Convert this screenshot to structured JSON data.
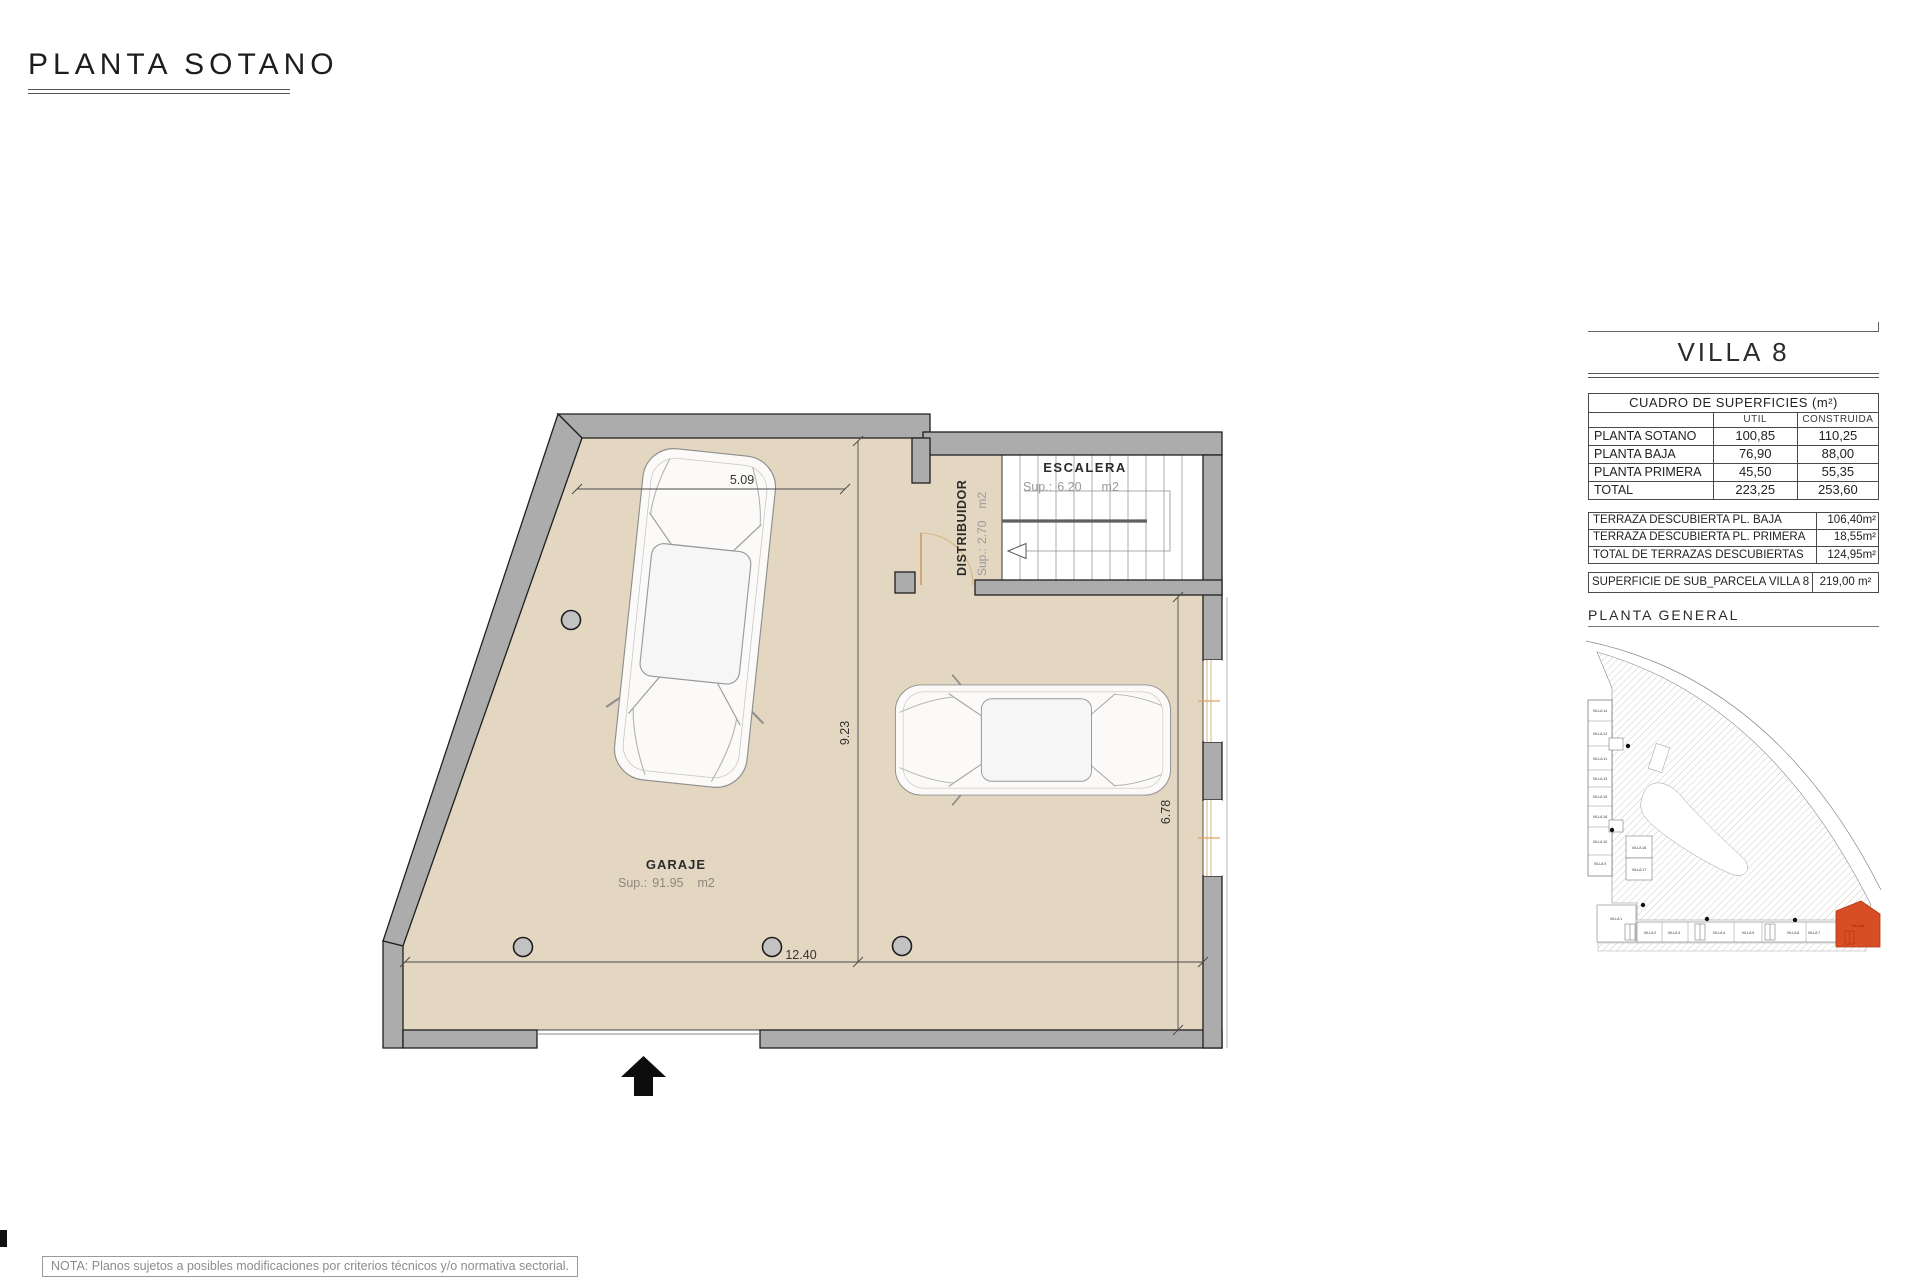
{
  "page": {
    "title": "PLANTA SOTANO",
    "note": "NOTA: Planos sujetos a posibles modificaciones por criterios técnicos y/o normativa sectorial."
  },
  "plan": {
    "rooms": {
      "garaje": {
        "name": "GARAJE",
        "sup_label": "Sup.:",
        "area": "91.95",
        "unit": "m2"
      },
      "escalera": {
        "name": "ESCALERA",
        "sup_label": "Sup.:",
        "area": "6.20",
        "unit": "m2"
      },
      "distribuidor": {
        "name": "DISTRIBUIDOR",
        "sup_label": "Sup.:",
        "area": "2.70",
        "unit": "m2"
      }
    },
    "dimensions": {
      "top": "5.09",
      "middle_vertical": "9.23",
      "right_vertical": "6.78",
      "bottom": "12.40"
    }
  },
  "panel": {
    "villa_title": "VILLA 8",
    "surfaces": {
      "title": "CUADRO DE SUPERFICIES (m²)",
      "col_util": "UTIL",
      "col_construida": "CONSTRUIDA",
      "rows": [
        {
          "label": "PLANTA SOTANO",
          "util": "100,85",
          "construida": "110,25"
        },
        {
          "label": "PLANTA BAJA",
          "util": "76,90",
          "construida": "88,00"
        },
        {
          "label": "PLANTA PRIMERA",
          "util": "45,50",
          "construida": "55,35"
        },
        {
          "label": "TOTAL",
          "util": "223,25",
          "construida": "253,60"
        }
      ]
    },
    "terraces": {
      "rows": [
        {
          "label": "TERRAZA DESCUBIERTA PL. BAJA",
          "value": "106,40m²"
        },
        {
          "label": "TERRAZA DESCUBIERTA PL. PRIMERA",
          "value": "18,55m²"
        },
        {
          "label": "TOTAL DE TERRAZAS DESCUBIERTAS",
          "value": "124,95m²"
        }
      ]
    },
    "subparcel": {
      "label": "SUPERFICIE DE SUB_PARCELA VILLA 8",
      "value": "219,00 m²"
    },
    "site_plan": {
      "title": "PLANTA GENERAL",
      "left_villas": [
        "VILLA 14",
        "VILLA 12",
        "VILLA 11",
        "VILLA 13",
        "VILLA 15",
        "VILLA 16",
        "VILLA 10",
        "VILLA 9"
      ],
      "inner_villas": [
        "VILLA 18",
        "VILLA 17"
      ],
      "bottom_villas": [
        "VILLA 1",
        "VILLA 2",
        "VILLA 3",
        "VILLA 4",
        "VILLA 5",
        "VILLA 6",
        "VILLA 7"
      ],
      "highlight_villa": "VILLA 8"
    }
  },
  "colors": {
    "floor": "#E3D7C2",
    "wall": "#ACACAC",
    "accent": "#D84E24",
    "window": "#D9B483"
  }
}
